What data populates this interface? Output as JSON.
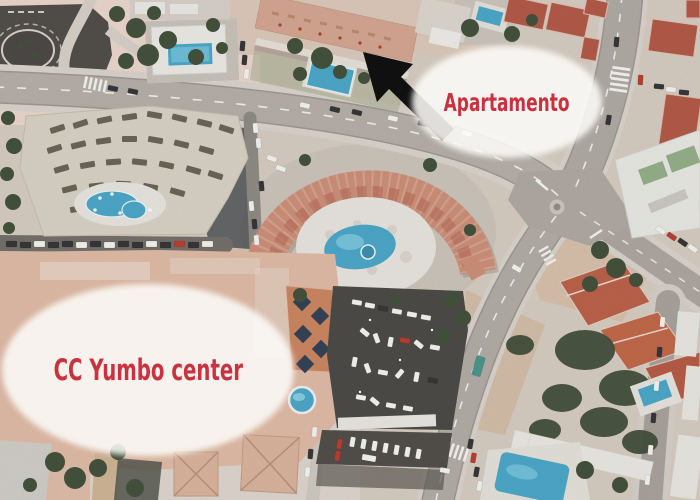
{
  "annotations": {
    "apartment_label": "Apartamento",
    "yumbo_label": "CC Yumbo center",
    "text_color": "#c93340",
    "bubble_color": "#fcfaf7",
    "arrow_color": "#101010"
  },
  "map": {
    "type": "aerial-satellite-photo",
    "palette": {
      "ground": "#d7cbc0",
      "ground_pink": "#ecd6cb",
      "road": "#b3ada6",
      "sidewalk": "#d9d3cb",
      "asphalt_dark": "#47443f",
      "roof_terracotta": "#b5523d",
      "roof_salmon": "#d7a28c",
      "horseshoe_roof": "#d08a72",
      "yumbo_roof": "#e2b9a2",
      "pool_blue": "#3fa6cc",
      "tree_green": "#3a4a33",
      "building_white": "#ebe9e5",
      "skylight_navy": "#2b3a52",
      "car_white": "#f4f4f2",
      "car_dark": "#2e2e32",
      "car_red": "#c23327",
      "bus_green": "#3e9488"
    }
  }
}
